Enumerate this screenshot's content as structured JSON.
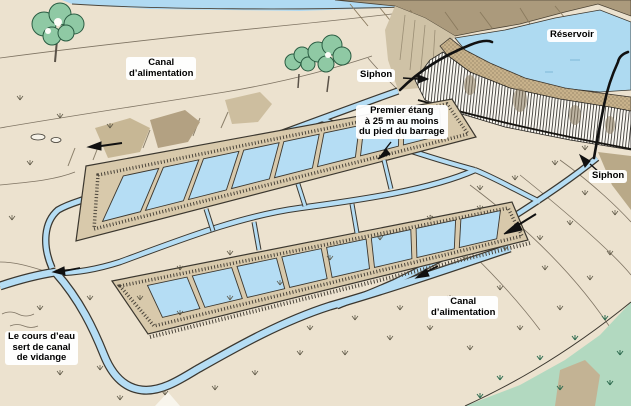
{
  "labels": {
    "canal_alimentation_top": {
      "line1": "Canal",
      "line2": "d’alimentation"
    },
    "siphon_top": {
      "text": "Siphon"
    },
    "reservoir": {
      "text": "Réservoir"
    },
    "premier_etang": {
      "line1": "Premier étang",
      "line2": "à 25 m au moins",
      "line3": "du pied du barrage"
    },
    "siphon_right": {
      "text": "Siphon"
    },
    "canal_alimentation_bottom": {
      "line1": "Canal",
      "line2": "d’alimentation"
    },
    "cours_eau": {
      "line1": "Le cours d’eau",
      "line2": "sert de canal",
      "line3": "de vidange"
    }
  },
  "ponds": {
    "upper_row_count": 8,
    "lower_row_count": 8
  },
  "colors": {
    "terrain": "#ece2cf",
    "water": "#b5ddf4",
    "reservoir": "#aedaf1",
    "dike": "#d8c9ab",
    "hill_brown": "#ab9a7c",
    "dam_crest": "#c8b28b",
    "tree_green": "#8fc9a4",
    "grass_green": "#b2d9c0",
    "outline": "#3b372f",
    "label_text": "#000000",
    "label_bg": "#ffffff"
  }
}
